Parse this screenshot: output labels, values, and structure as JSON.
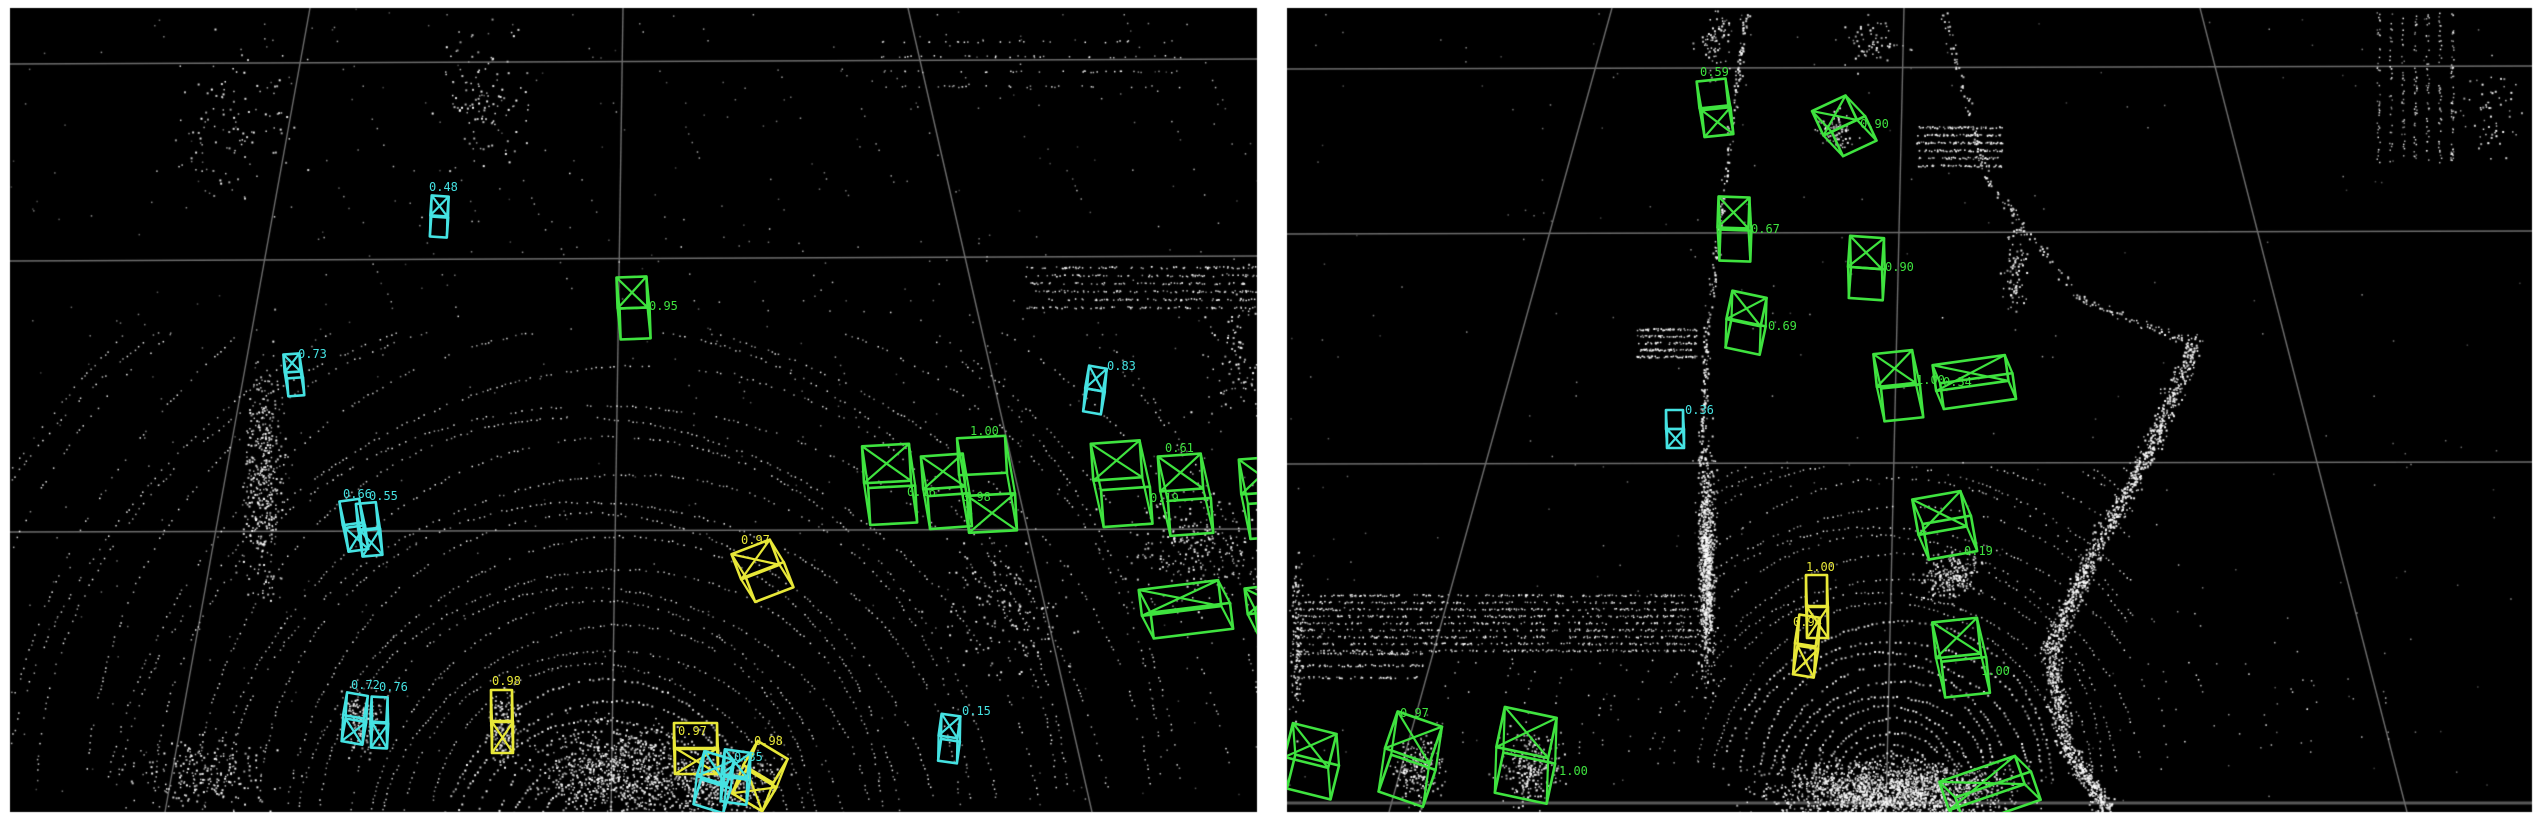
{
  "meta": {
    "page_bg": "#ffffff",
    "panel_bg": "#000000",
    "grid_color": "#6e6e6e",
    "grid_color_strong": "#585858",
    "origin_marker_color": "#909090",
    "point_color": "#ffffff",
    "label_font_px": 12,
    "box_colors": {
      "g": "#3fe33f",
      "c": "#45e2e2",
      "y": "#e8e838"
    }
  },
  "panels": [
    {
      "id": "left",
      "rect": [
        10,
        8,
        1247,
        804
      ],
      "grid": {
        "h": [
          [
            10,
            64,
            1257,
            59,
            1.4
          ],
          [
            10,
            261,
            1257,
            256,
            1.4
          ],
          [
            10,
            532,
            1257,
            529,
            1.4
          ]
        ],
        "v": [
          [
            310,
            8,
            165,
            812,
            1.4
          ],
          [
            623,
            8,
            611,
            812,
            1.4
          ],
          [
            908,
            8,
            1092,
            812,
            1.4
          ]
        ]
      },
      "rings": {
        "cx": 604,
        "cy": 846,
        "base": 56,
        "lin": 13,
        "quad": 0.34,
        "count": 30,
        "a0": 187,
        "a1": 353
      },
      "clusters": [
        {
          "t": "streaks",
          "x": 260,
          "y": 14,
          "w": 980,
          "h": 300,
          "lines": 16,
          "dx": 0.45,
          "step": 6,
          "keep": 0.32
        },
        {
          "t": "blob",
          "x": 262,
          "y": 480,
          "sx": 16,
          "sy": 95,
          "n": 420
        },
        {
          "t": "blob",
          "x": 230,
          "y": 120,
          "sx": 50,
          "sy": 60,
          "n": 110
        },
        {
          "t": "blob",
          "x": 480,
          "y": 100,
          "sx": 38,
          "sy": 55,
          "n": 120
        },
        {
          "t": "band",
          "x": 1025,
          "y": 266,
          "w": 232,
          "h": 48,
          "rows": 6,
          "n": 430
        },
        {
          "t": "band",
          "x": 880,
          "y": 40,
          "w": 300,
          "h": 60,
          "rows": 4,
          "n": 120
        },
        {
          "t": "blob",
          "x": 1195,
          "y": 545,
          "sx": 55,
          "sy": 48,
          "n": 240
        },
        {
          "t": "blob",
          "x": 1010,
          "y": 610,
          "sx": 55,
          "sy": 55,
          "n": 150
        },
        {
          "t": "blob",
          "x": 618,
          "y": 768,
          "sx": 65,
          "sy": 38,
          "n": 700
        },
        {
          "t": "blob",
          "x": 716,
          "y": 782,
          "sx": 50,
          "sy": 28,
          "n": 450
        },
        {
          "t": "blob",
          "x": 503,
          "y": 726,
          "sx": 12,
          "sy": 28,
          "n": 150
        },
        {
          "t": "blob",
          "x": 360,
          "y": 722,
          "sx": 16,
          "sy": 26,
          "n": 150
        },
        {
          "t": "blob",
          "x": 200,
          "y": 775,
          "sx": 55,
          "sy": 32,
          "n": 240
        },
        {
          "t": "streaks",
          "x": 640,
          "y": 300,
          "w": 420,
          "h": 130,
          "lines": 8,
          "dx": 0.55,
          "step": 6,
          "keep": 0.3
        },
        {
          "t": "blob",
          "x": 1238,
          "y": 360,
          "sx": 30,
          "sy": 55,
          "n": 100
        },
        {
          "t": "noise",
          "n": 380
        }
      ],
      "boxes": [
        {
          "c": "c",
          "x": 431,
          "y": 196,
          "w": 17,
          "h": 20,
          "ox": 1,
          "oy": 21,
          "r": 4,
          "cross": "a",
          "lab": "0.48",
          "lx": -2,
          "ly": -5
        },
        {
          "c": "g",
          "x": 617,
          "y": 277,
          "w": 30,
          "h": 31,
          "ox": 2,
          "oy": 31,
          "r": -2,
          "cross": "a",
          "lab": "0.95",
          "lx": 32,
          "ly": 33
        },
        {
          "c": "c",
          "x": 284,
          "y": 354,
          "w": 16,
          "h": 18,
          "ox": 2,
          "oy": 24,
          "r": -4,
          "cross": "a",
          "lab": "0.73",
          "lx": 14,
          "ly": 4
        },
        {
          "c": "c",
          "x": 341,
          "y": 500,
          "w": 20,
          "h": 24,
          "ox": 2,
          "oy": 27,
          "r": -8,
          "cross": "b",
          "lab": "0.66",
          "lx": 2,
          "ly": -2
        },
        {
          "c": "c",
          "x": 357,
          "y": 503,
          "w": 20,
          "h": 26,
          "ox": 2,
          "oy": 27,
          "r": -5,
          "cross": "b",
          "lab": "0.55",
          "lx": 12,
          "ly": -3
        },
        {
          "c": "c",
          "x": 345,
          "y": 694,
          "w": 21,
          "h": 23,
          "ox": 3,
          "oy": 26,
          "r": 10,
          "cross": "b",
          "lab": "0.72",
          "lx": 6,
          "ly": -5
        },
        {
          "c": "c",
          "x": 371,
          "y": 697,
          "w": 16,
          "h": 25,
          "ox": 2,
          "oy": 26,
          "r": 3,
          "cross": "b",
          "lab": "0.76",
          "lx": 8,
          "ly": -6
        },
        {
          "c": "y",
          "x": 491,
          "y": 690,
          "w": 21,
          "h": 31,
          "ox": 1,
          "oy": 32,
          "r": 0,
          "cross": "b",
          "lab": "0.98",
          "lx": 1,
          "ly": -5
        },
        {
          "c": "y",
          "x": 735,
          "y": 546,
          "w": 41,
          "h": 27,
          "ox": 5,
          "oy": 26,
          "r": -21,
          "cross": "a",
          "lab": "0.97",
          "lx": 6,
          "ly": -2
        },
        {
          "c": "y",
          "x": 674,
          "y": 723,
          "w": 43,
          "h": 26,
          "ox": 1,
          "oy": 25,
          "r": 0,
          "cross": "b",
          "lab": "0.97",
          "lx": 4,
          "ly": 12
        },
        {
          "c": "y",
          "x": 748,
          "y": 748,
          "w": 35,
          "h": 28,
          "ox": 5,
          "oy": 30,
          "r": 31,
          "cross": "b",
          "lab": "0.98",
          "lx": 6,
          "ly": -3
        },
        {
          "c": "c",
          "x": 700,
          "y": 755,
          "w": 31,
          "h": 26,
          "ox": 5,
          "oy": 28,
          "r": 17,
          "cross": "a",
          "lab": "0.35",
          "lx": 34,
          "ly": 6
        },
        {
          "c": "c",
          "x": 723,
          "y": 751,
          "w": 26,
          "h": 25,
          "ox": 3,
          "oy": 27,
          "r": 8,
          "cross": "a",
          "lab": ""
        },
        {
          "c": "c",
          "x": 940,
          "y": 715,
          "w": 19,
          "h": 22,
          "ox": 3,
          "oy": 25,
          "r": 8,
          "cross": "a",
          "lab": "0.15",
          "lx": 22,
          "ly": 0
        },
        {
          "c": "c",
          "x": 1087,
          "y": 367,
          "w": 18,
          "h": 23,
          "ox": 2,
          "oy": 23,
          "r": 10,
          "cross": "a",
          "lab": "0.83",
          "lx": 20,
          "ly": 3
        },
        {
          "c": "g",
          "x": 863,
          "y": 445,
          "w": 47,
          "h": 37,
          "ox": 4,
          "oy": 42,
          "r": -3,
          "cross": "a",
          "lab": "0.16",
          "lx": 44,
          "ly": 51
        },
        {
          "c": "g",
          "x": 922,
          "y": 455,
          "w": 42,
          "h": 33,
          "ox": 4,
          "oy": 40,
          "r": -4,
          "cross": "a",
          "lab": "0.98",
          "lx": 40,
          "ly": 46
        },
        {
          "c": "g",
          "x": 958,
          "y": 437,
          "w": 48,
          "h": 37,
          "ox": 7,
          "oy": 58,
          "r": -3,
          "cross": "b",
          "lab": "1.00",
          "lx": 12,
          "ly": -2
        },
        {
          "c": "g",
          "x": 1092,
          "y": 442,
          "w": 49,
          "h": 37,
          "ox": 7,
          "oy": 47,
          "r": -4,
          "cross": "a",
          "lab": "0.19",
          "lx": 58,
          "ly": 60
        },
        {
          "c": "g",
          "x": 1159,
          "y": 455,
          "w": 43,
          "h": 35,
          "ox": 7,
          "oy": 45,
          "r": -4,
          "cross": "a",
          "lab": "0.61",
          "lx": 6,
          "ly": -3
        },
        {
          "c": "g",
          "x": 1240,
          "y": 458,
          "w": 42,
          "h": 35,
          "ox": 6,
          "oy": 45,
          "r": -4,
          "cross": "a",
          "lab": ""
        },
        {
          "c": "g",
          "x": 1140,
          "y": 585,
          "w": 80,
          "h": 26,
          "ox": 9,
          "oy": 24,
          "r": -7,
          "cross": "a",
          "lab": ""
        },
        {
          "c": "g",
          "x": 1246,
          "y": 586,
          "w": 40,
          "h": 26,
          "ox": 8,
          "oy": 22,
          "r": -7,
          "cross": "a",
          "lab": ""
        }
      ]
    },
    {
      "id": "right",
      "rect": [
        1287,
        8,
        1245,
        804
      ],
      "grid": {
        "h": [
          [
            1287,
            69,
            2532,
            66,
            1.4
          ],
          [
            1287,
            234,
            2532,
            231,
            1.4
          ],
          [
            1287,
            464,
            2532,
            462,
            1.4
          ],
          [
            1287,
            803,
            2532,
            803,
            3
          ]
        ],
        "v": [
          [
            1612,
            8,
            1389,
            812,
            1.4
          ],
          [
            1904,
            8,
            1886,
            812,
            1.4
          ],
          [
            2200,
            8,
            2407,
            812,
            1.4
          ]
        ],
        "origin": [
          1886,
          801
        ]
      },
      "rings": {
        "cx": 1890,
        "cy": 788,
        "base": 34,
        "lin": 11,
        "quad": 0.22,
        "count": 28,
        "a0": 185,
        "a1": 355
      },
      "clusters": [
        {
          "t": "blob",
          "x": 1890,
          "y": 792,
          "sx": 95,
          "sy": 26,
          "n": 2000
        },
        {
          "t": "path",
          "pts": [
            [
              1745,
              12
            ],
            [
              1725,
              180
            ],
            [
              1706,
              340
            ],
            [
              1700,
              468
            ]
          ],
          "n": 260,
          "sp": 3
        },
        {
          "t": "blob",
          "x": 1706,
          "y": 565,
          "sx": 7,
          "sy": 92,
          "n": 850
        },
        {
          "t": "band",
          "x": 1292,
          "y": 594,
          "w": 406,
          "h": 62,
          "rows": 9,
          "n": 1250
        },
        {
          "t": "band",
          "x": 1292,
          "y": 652,
          "w": 130,
          "h": 36,
          "rows": 3,
          "n": 180
        },
        {
          "t": "path",
          "pts": [
            [
              2196,
              338
            ],
            [
              2148,
              452
            ],
            [
              2088,
              560
            ],
            [
              2050,
              650
            ],
            [
              2064,
              745
            ],
            [
              2108,
              810
            ]
          ],
          "n": 1500,
          "sp": 8
        },
        {
          "t": "path",
          "pts": [
            [
              1944,
              10
            ],
            [
              1986,
              180
            ],
            [
              2082,
              300
            ],
            [
              2190,
              342
            ]
          ],
          "n": 200,
          "sp": 4
        },
        {
          "t": "band",
          "x": 1636,
          "y": 328,
          "w": 60,
          "h": 34,
          "rows": 5,
          "n": 240
        },
        {
          "t": "band",
          "x": 1916,
          "y": 126,
          "w": 86,
          "h": 46,
          "rows": 6,
          "n": 360
        },
        {
          "t": "pillars",
          "x": 2378,
          "y": 12,
          "w": 86,
          "h": 150,
          "cols": 7,
          "n": 300
        },
        {
          "t": "blob",
          "x": 2492,
          "y": 115,
          "sx": 28,
          "sy": 38,
          "n": 60
        },
        {
          "t": "blob",
          "x": 1950,
          "y": 576,
          "sx": 26,
          "sy": 20,
          "n": 220
        },
        {
          "t": "blob",
          "x": 1418,
          "y": 768,
          "sx": 20,
          "sy": 28,
          "n": 200
        },
        {
          "t": "blob",
          "x": 1530,
          "y": 768,
          "sx": 24,
          "sy": 28,
          "n": 240
        },
        {
          "t": "blob",
          "x": 1835,
          "y": 132,
          "sx": 15,
          "sy": 16,
          "n": 80
        },
        {
          "t": "blob",
          "x": 2014,
          "y": 268,
          "sx": 9,
          "sy": 38,
          "n": 90
        },
        {
          "t": "blob",
          "x": 1872,
          "y": 42,
          "sx": 26,
          "sy": 20,
          "n": 60
        },
        {
          "t": "blob",
          "x": 1714,
          "y": 40,
          "sx": 16,
          "sy": 30,
          "n": 70
        },
        {
          "t": "blob",
          "x": 1296,
          "y": 640,
          "sx": 5,
          "sy": 70,
          "n": 120
        },
        {
          "t": "noise",
          "n": 280
        }
      ],
      "boxes": [
        {
          "c": "g",
          "x": 1698,
          "y": 80,
          "w": 29,
          "h": 27,
          "ox": 2,
          "oy": 29,
          "r": -6,
          "cross": "b",
          "lab": "0.59",
          "lx": 2,
          "ly": -4
        },
        {
          "c": "g",
          "x": 1816,
          "y": 102,
          "w": 37,
          "h": 27,
          "ox": 9,
          "oy": 27,
          "r": -25,
          "cross": "a",
          "lab": "0.90",
          "lx": 44,
          "ly": 26
        },
        {
          "c": "g",
          "x": 1718,
          "y": 197,
          "w": 31,
          "h": 31,
          "ox": 3,
          "oy": 33,
          "r": 2,
          "cross": "a",
          "lab": "0.67",
          "lx": 33,
          "ly": 36
        },
        {
          "c": "g",
          "x": 1849,
          "y": 237,
          "w": 34,
          "h": 31,
          "ox": 3,
          "oy": 31,
          "r": 4,
          "cross": "a",
          "lab": "0.90",
          "lx": 36,
          "ly": 34
        },
        {
          "c": "g",
          "x": 1729,
          "y": 294,
          "w": 35,
          "h": 29,
          "ox": 5,
          "oy": 28,
          "r": 12,
          "cross": "a",
          "lab": "0.69",
          "lx": 39,
          "ly": 36
        },
        {
          "c": "g",
          "x": 1875,
          "y": 352,
          "w": 39,
          "h": 33,
          "ox": 4,
          "oy": 35,
          "r": -6,
          "cross": "a",
          "lab": "1.00",
          "lx": 41,
          "ly": 32
        },
        {
          "c": "g",
          "x": 1934,
          "y": 360,
          "w": 73,
          "h": 26,
          "ox": 5,
          "oy": 19,
          "r": -8,
          "cross": "a",
          "lab": "0.34",
          "lx": 9,
          "ly": 26
        },
        {
          "c": "c",
          "x": 1666,
          "y": 410,
          "w": 17,
          "h": 19,
          "ox": 1,
          "oy": 19,
          "r": 0,
          "cross": "b",
          "lab": "0.36",
          "lx": 19,
          "ly": 4
        },
        {
          "c": "g",
          "x": 1915,
          "y": 495,
          "w": 49,
          "h": 36,
          "ox": 6,
          "oy": 26,
          "r": -10,
          "cross": "a",
          "lab": "0.19",
          "lx": 49,
          "ly": 60
        },
        {
          "c": "g",
          "x": 1934,
          "y": 620,
          "w": 45,
          "h": 36,
          "ox": 5,
          "oy": 40,
          "r": -6,
          "cross": "a",
          "lab": "1.00",
          "lx": 47,
          "ly": 55
        },
        {
          "c": "y",
          "x": 1806,
          "y": 575,
          "w": 21,
          "h": 31,
          "ox": 1,
          "oy": 32,
          "r": 0,
          "cross": "b",
          "lab": "1.00",
          "lx": 0,
          "ly": -4
        },
        {
          "c": "y",
          "x": 1797,
          "y": 616,
          "w": 21,
          "h": 29,
          "ox": 3,
          "oy": 31,
          "r": 9,
          "cross": "b",
          "lab": "0.94",
          "lx": -4,
          "ly": 10
        },
        {
          "c": "g",
          "x": 1288,
          "y": 728,
          "w": 45,
          "h": 35,
          "ox": 10,
          "oy": 30,
          "r": 14,
          "cross": "a",
          "lab": ""
        },
        {
          "c": "g",
          "x": 1390,
          "y": 718,
          "w": 47,
          "h": 39,
          "ox": 8,
          "oy": 43,
          "r": 19,
          "cross": "a",
          "lab": "0.97",
          "lx": 10,
          "ly": -1
        },
        {
          "c": "g",
          "x": 1500,
          "y": 712,
          "w": 53,
          "h": 41,
          "ox": 8,
          "oy": 45,
          "r": 12,
          "cross": "a",
          "lab": "1.00",
          "lx": 59,
          "ly": 63
        },
        {
          "c": "g",
          "x": 1942,
          "y": 768,
          "w": 80,
          "h": 30,
          "ox": 10,
          "oy": 20,
          "r": -19,
          "cross": "a",
          "lab": ""
        }
      ]
    }
  ]
}
